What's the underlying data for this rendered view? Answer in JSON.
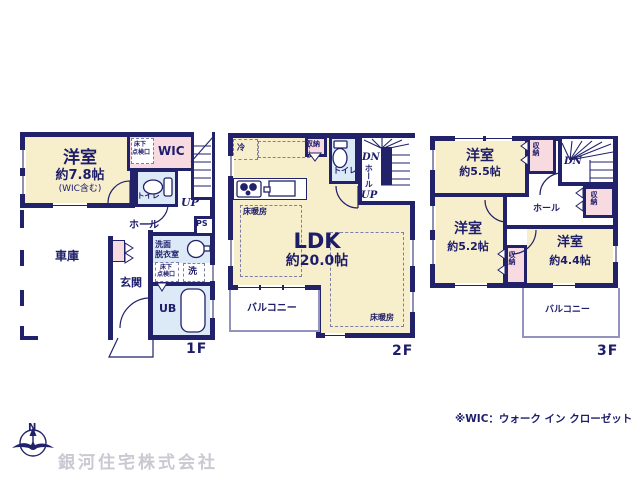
{
  "colors": {
    "wall": "#22226b",
    "room_cream": "#f7eecb",
    "storage_pink": "#f8dbe0",
    "wet_area_blue": "#dceaf8",
    "text_navy": "#1d1d6a",
    "balcony_line": "#9393bd",
    "company_gray": "#c9c9d2"
  },
  "compass": {
    "n": "N"
  },
  "footer": {
    "wic_note": "※WIC：ウォーク イン クローゼット",
    "company": "銀河住宅株式会社"
  },
  "floor1": {
    "label": "1F",
    "room1_name": "洋室",
    "room1_size": "約7.8帖",
    "room1_note": "(WIC含む)",
    "wic": "WIC",
    "access_a": "床下",
    "access_b": "点検口",
    "toilet": "トイレ",
    "up": "UP",
    "hall": "ホール",
    "garage": "車庫",
    "genkan": "玄関",
    "ps": "PS",
    "washroom_a": "洗面",
    "washroom_b": "脱衣室",
    "access2_a": "床下",
    "access2_b": "点検口",
    "laundry": "洗",
    "bath": "UB"
  },
  "floor2": {
    "label": "2F",
    "fridge": "冷",
    "storage": "収納",
    "toilet": "トイレ",
    "dn": "DN",
    "hall": "ホール",
    "up": "UP",
    "floor_heating": "床暖房",
    "ldk_name": "LDK",
    "ldk_size": "約20.0帖",
    "floor_heating2": "床暖房",
    "balcony": "バルコニー"
  },
  "floor3": {
    "label": "3F",
    "room1_name": "洋室",
    "room1_size": "約5.5帖",
    "storage1": "収納",
    "dn": "DN",
    "storage2": "収納",
    "hall": "ホール",
    "room2_name": "洋室",
    "room2_size": "約5.2帖",
    "storage3": "収納",
    "room3_name": "洋室",
    "room3_size": "約4.4帖",
    "balcony": "バルコニー"
  }
}
